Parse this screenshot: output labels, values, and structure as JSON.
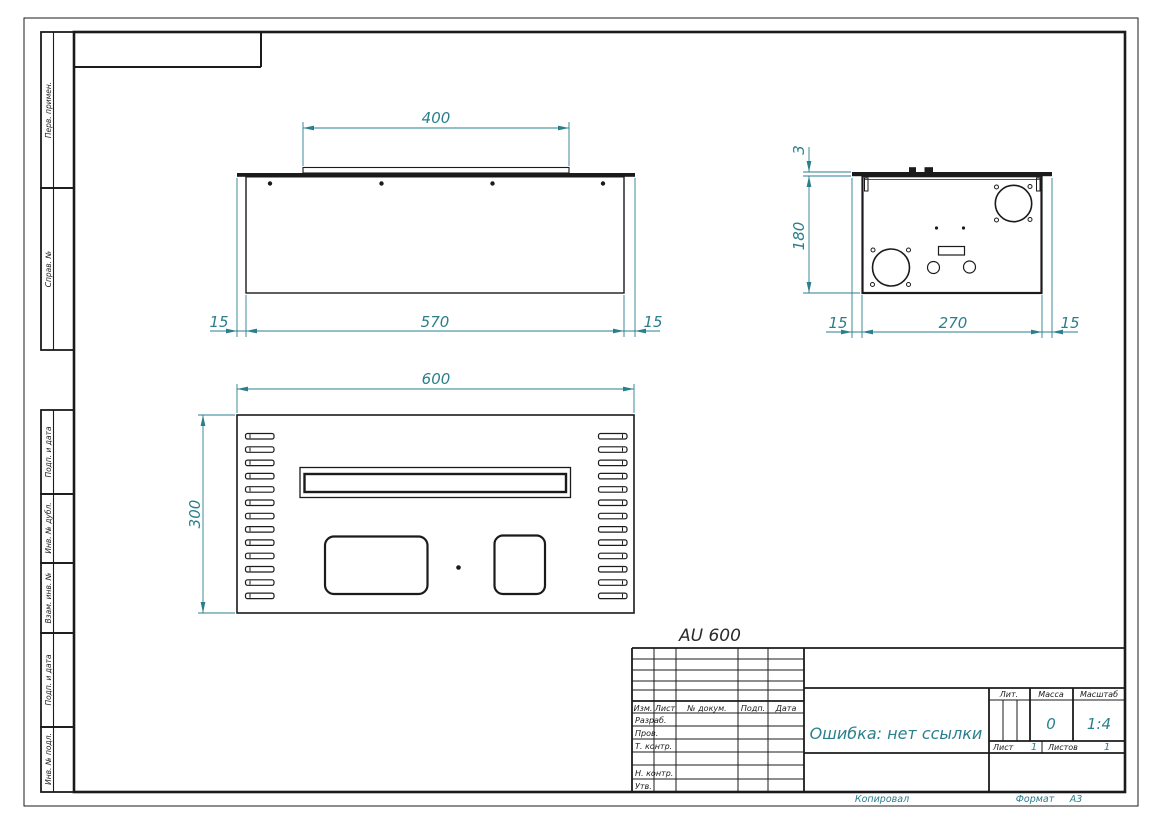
{
  "colors": {
    "accent": "#2a7f8d",
    "line": "#1b1b1b"
  },
  "model_label": "AU 600",
  "margin_stamps": {
    "items": [
      {
        "label": "Перв. примен."
      },
      {
        "label": "Справ. №"
      },
      {
        "label": "Подп. и дата"
      },
      {
        "label": "Инв. № дубл."
      },
      {
        "label": "Взам. инв. №"
      },
      {
        "label": "Подп. и дата"
      },
      {
        "label": "Инв. № подл."
      }
    ]
  },
  "dimensions": {
    "top_view": {
      "lid_width": "400",
      "flange_left": "15",
      "body_width": "570",
      "flange_right": "15"
    },
    "side_view": {
      "lid_thickness": "3",
      "height": "180",
      "flange_left": "15",
      "body_depth": "270",
      "flange_right": "15"
    },
    "front_view": {
      "width": "600",
      "height": "300"
    }
  },
  "title_block": {
    "title": "Ошибка: нет ссылки",
    "columns": {
      "izm": "Изм.",
      "list": "Лист",
      "doc": "№ докум.",
      "podp": "Подп.",
      "data": "Дата"
    },
    "rows": {
      "razrab": "Разраб.",
      "prov": "Пров.",
      "tkontr": "Т. контр.",
      "nkontr": "Н. контр.",
      "utv": "Утв."
    },
    "lit_label": "Лит.",
    "massa_label": "Масса",
    "masshtab_label": "Масштаб",
    "massa_value": "0",
    "masshtab_value": "1:4",
    "list_label": "Лист",
    "list_value": "1",
    "listov_label": "Листов",
    "listov_value": "1"
  },
  "footer": {
    "kopiroval": "Копировал",
    "format_label": "Формат",
    "format_value": "А3"
  }
}
